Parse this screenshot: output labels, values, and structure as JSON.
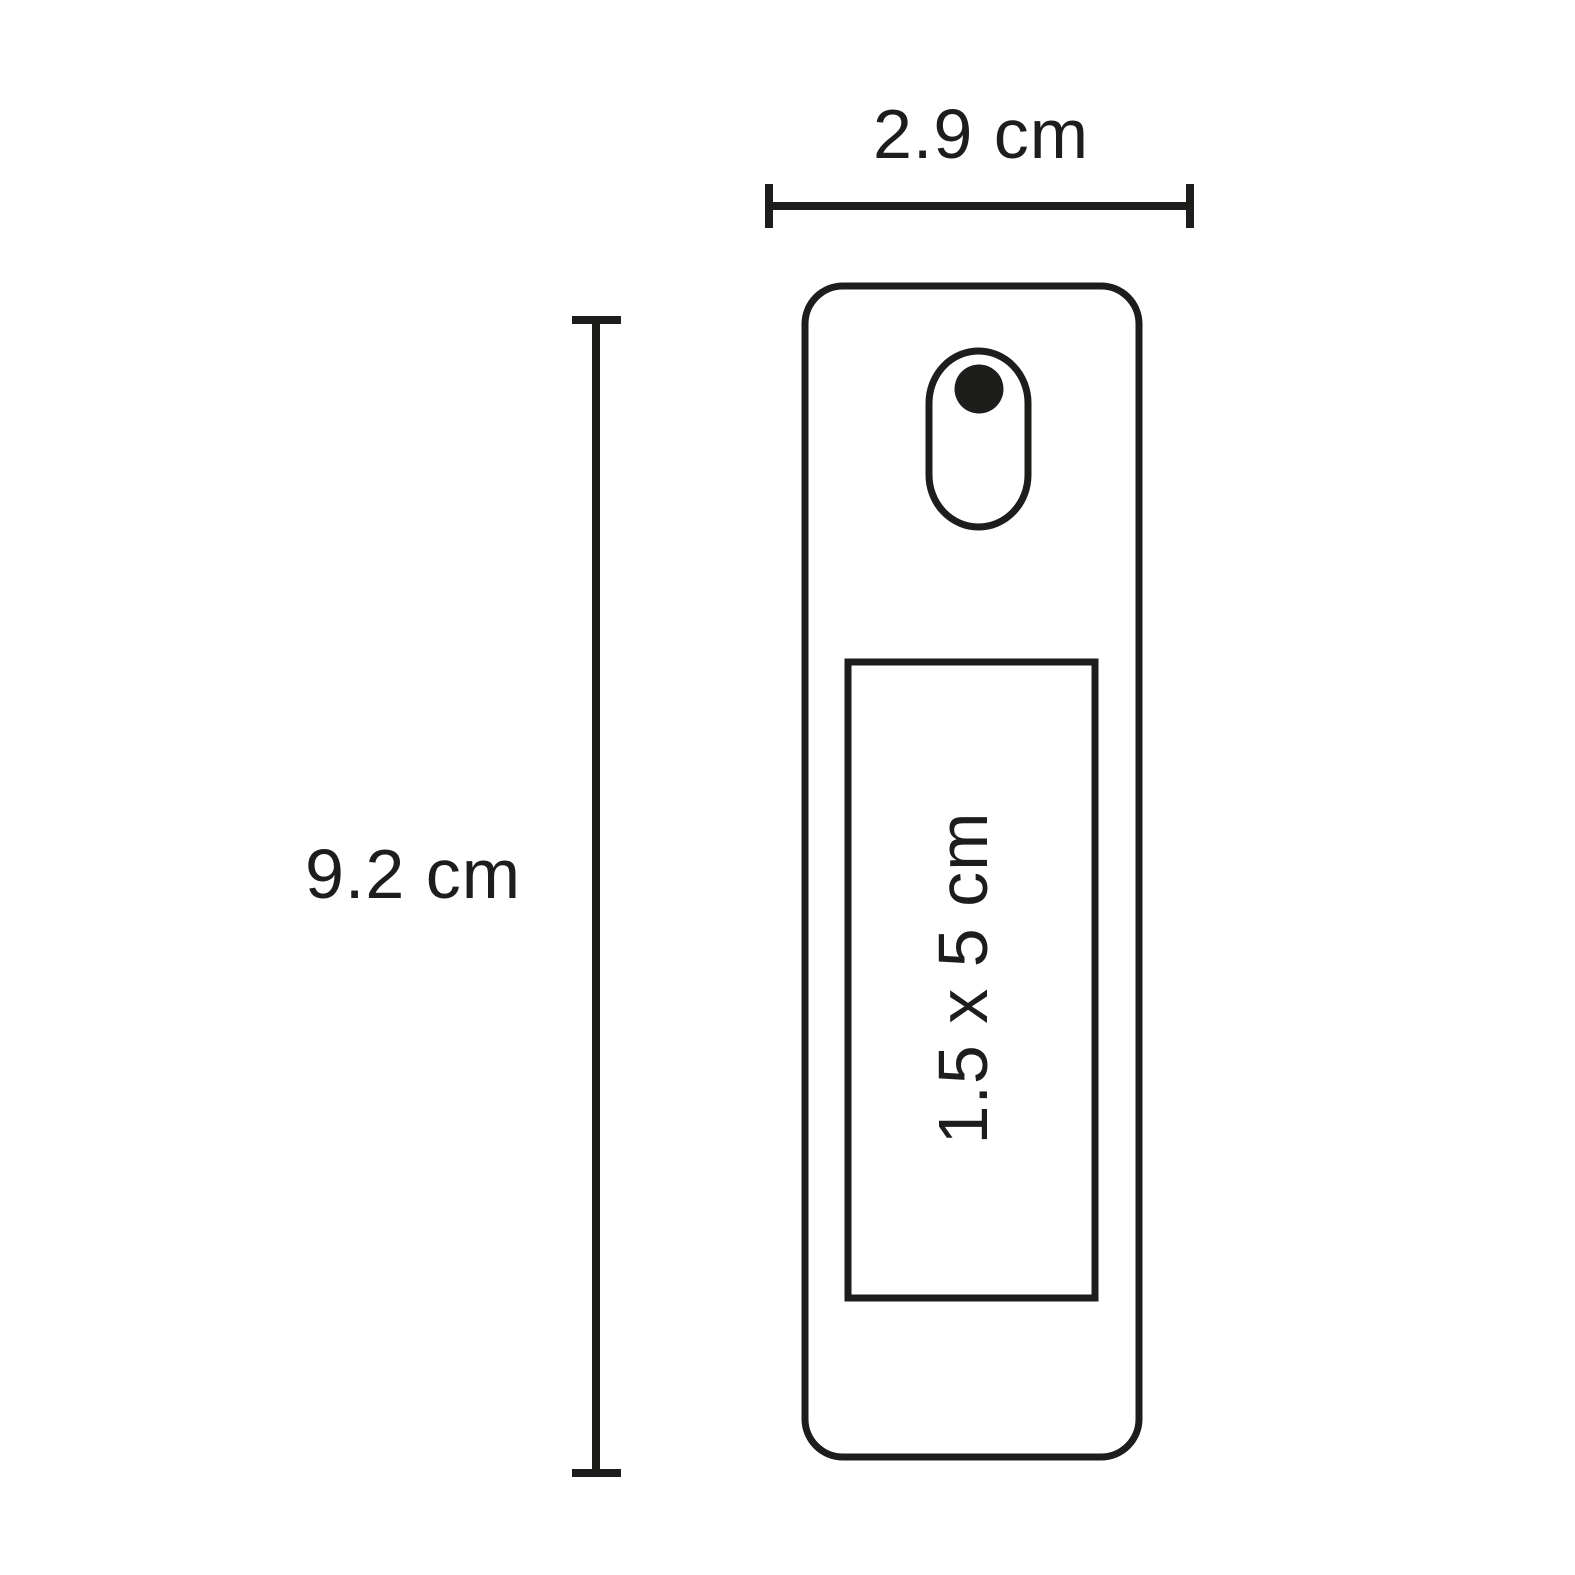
{
  "diagram": {
    "width_dimension": {
      "label": "2.9 cm"
    },
    "height_dimension": {
      "label": "9.2 cm"
    },
    "print_area": {
      "label": "1.5 x 5 cm"
    },
    "colors": {
      "line": "#1d1d1b",
      "background": "#ffffff"
    }
  }
}
